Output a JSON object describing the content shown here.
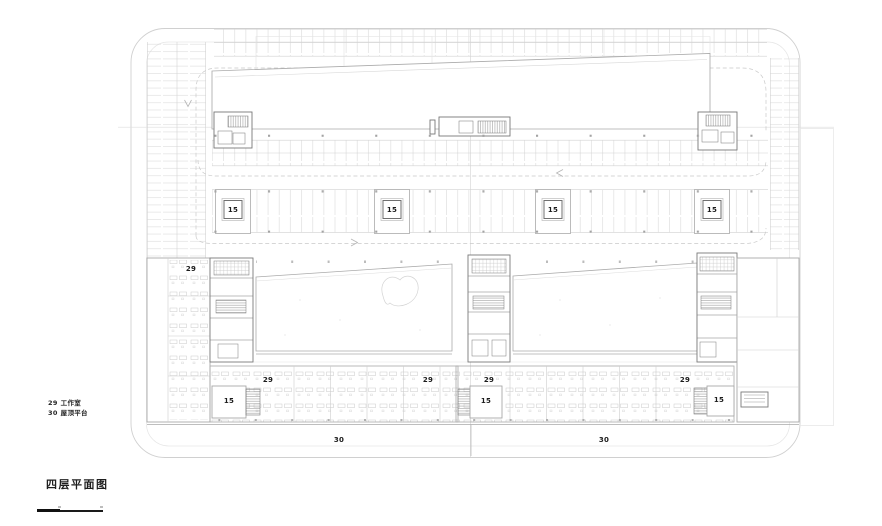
{
  "drawing": {
    "title": "四层平面图",
    "legend": [
      {
        "code": "29",
        "label": "工作室"
      },
      {
        "code": "30",
        "label": "屋顶平台"
      }
    ],
    "colors": {
      "line_light": "#d3d3d3",
      "line_mid": "#a9a9a9",
      "line_dark": "#767676",
      "text": "#1b1b1b"
    },
    "labels": [
      {
        "text": "15",
        "x": 233,
        "y": 210
      },
      {
        "text": "15",
        "x": 392,
        "y": 210
      },
      {
        "text": "15",
        "x": 553,
        "y": 210
      },
      {
        "text": "15",
        "x": 712,
        "y": 210
      },
      {
        "text": "15",
        "x": 229,
        "y": 401
      },
      {
        "text": "15",
        "x": 486,
        "y": 401
      },
      {
        "text": "15",
        "x": 719,
        "y": 400
      },
      {
        "text": "29",
        "x": 191,
        "y": 269
      },
      {
        "text": "29",
        "x": 268,
        "y": 380
      },
      {
        "text": "29",
        "x": 428,
        "y": 380
      },
      {
        "text": "29",
        "x": 489,
        "y": 380
      },
      {
        "text": "29",
        "x": 685,
        "y": 380
      },
      {
        "text": "30",
        "x": 339,
        "y": 440
      },
      {
        "text": "30",
        "x": 604,
        "y": 440
      }
    ]
  }
}
